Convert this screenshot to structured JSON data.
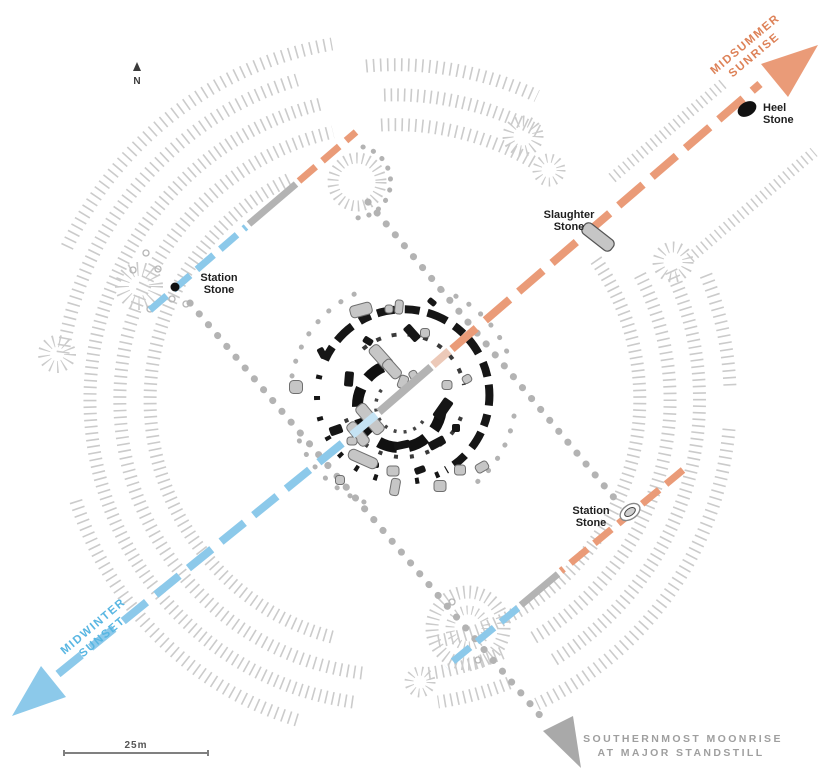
{
  "title": "Stonehenge solstice and lunar alignment plan",
  "compass": {
    "label": "N"
  },
  "alignments": {
    "midsummer_sunrise": {
      "label_line1": "MIDSUMMER",
      "label_line2": "SUNRISE",
      "color": "#ea9b78",
      "text_color": "#dd8157"
    },
    "midwinter_sunset": {
      "label_line1": "MIDWINTER",
      "label_line2": "SUNSET",
      "color": "#8cc9ea",
      "text_color": "#58b6e2"
    },
    "moonrise": {
      "label_line1": "SOUTHERNMOST MOONRISE",
      "label_line2": "AT MAJOR STANDSTILL",
      "color": "#a9a9a9",
      "text_color": "#9f9f9f"
    }
  },
  "stones": {
    "heel": {
      "line1": "Heel",
      "line2": "Stone"
    },
    "slaughter": {
      "line1": "Slaughter",
      "line2": "Stone"
    },
    "station_nw": {
      "line1": "Station",
      "line2": "Stone"
    },
    "station_se": {
      "line1": "Station",
      "line2": "Stone"
    }
  },
  "scale": {
    "label": "25m"
  },
  "colors": {
    "earthwork_hachure": "#cbcbcb",
    "station_rectangle_dots": "#b3b3b3",
    "neutral_line_gray": "#b3b3b3",
    "sarsen_black": "#161616",
    "fallen_stone_gray": "#c6c6c6",
    "background": "#ffffff"
  }
}
